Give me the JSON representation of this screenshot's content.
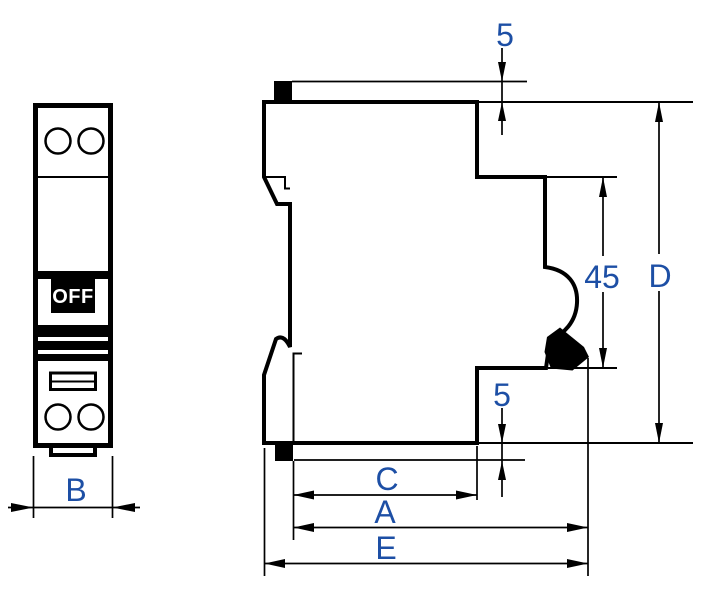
{
  "drawing": {
    "colors": {
      "line": "#000000",
      "dimension_text": "#1d4fa5",
      "toggle_fill": "#000000",
      "toggle_text": "#ffffff",
      "background": "#ffffff"
    },
    "front_view": {
      "toggle_label": "OFF"
    },
    "dimensions": {
      "front": {
        "width": "B"
      },
      "side": {
        "top_offset": "5",
        "recess_height": "45",
        "overall_height": "D",
        "bottom_offset": "5",
        "inner_depth": "C",
        "body_depth": "A",
        "overall_depth": "E"
      }
    }
  }
}
